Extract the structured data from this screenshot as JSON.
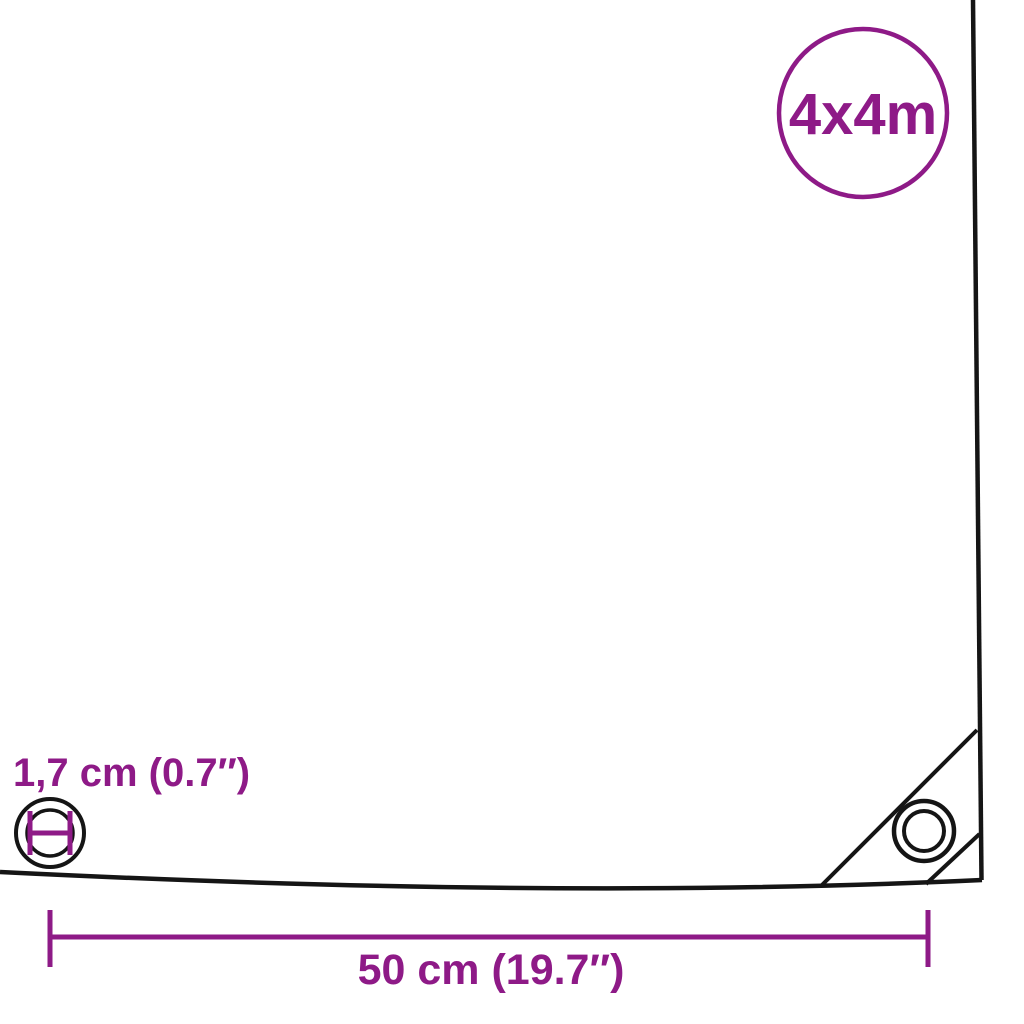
{
  "colors": {
    "accent": "#8E1A87",
    "ink": "#151515",
    "background": "#FFFFFF"
  },
  "product": {
    "type": "tarpaulin-dimension-diagram"
  },
  "badge": {
    "label": "4x4m"
  },
  "annotations": {
    "eyelet_diameter": {
      "label": "1,7 cm (0.7″)"
    },
    "eyelet_spacing": {
      "label": "50 cm (19.7″)"
    }
  }
}
